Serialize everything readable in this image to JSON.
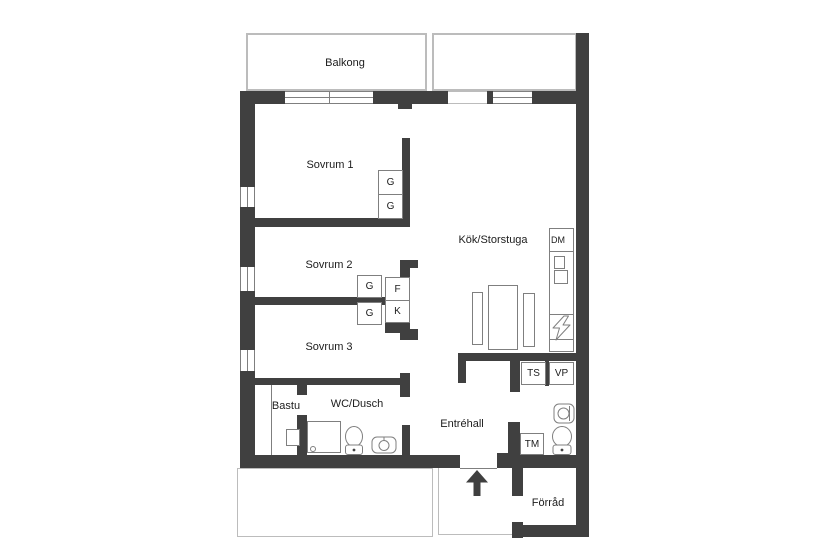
{
  "colors": {
    "wall": "#404040",
    "outline": "#7f7f7f",
    "light_outline": "#bcbcbc",
    "text": "#1c1c1c",
    "bg": "#ffffff"
  },
  "rooms": {
    "balcony": "Balkong",
    "bedroom1": "Sovrum 1",
    "bedroom2": "Sovrum 2",
    "bedroom3": "Sovrum 3",
    "kitchen_living": "Kök/Storstuga",
    "sauna": "Bastu",
    "bathroom": "WC/Dusch",
    "entry_hall": "Entréhall",
    "storage": "Förråd"
  },
  "fixtures": {
    "wardrobe": "G",
    "freezer": "F",
    "fridge": "K",
    "dishwasher": "DM",
    "drying_cabinet": "TS",
    "heat_pump": "VP",
    "washing_machine": "TM"
  }
}
